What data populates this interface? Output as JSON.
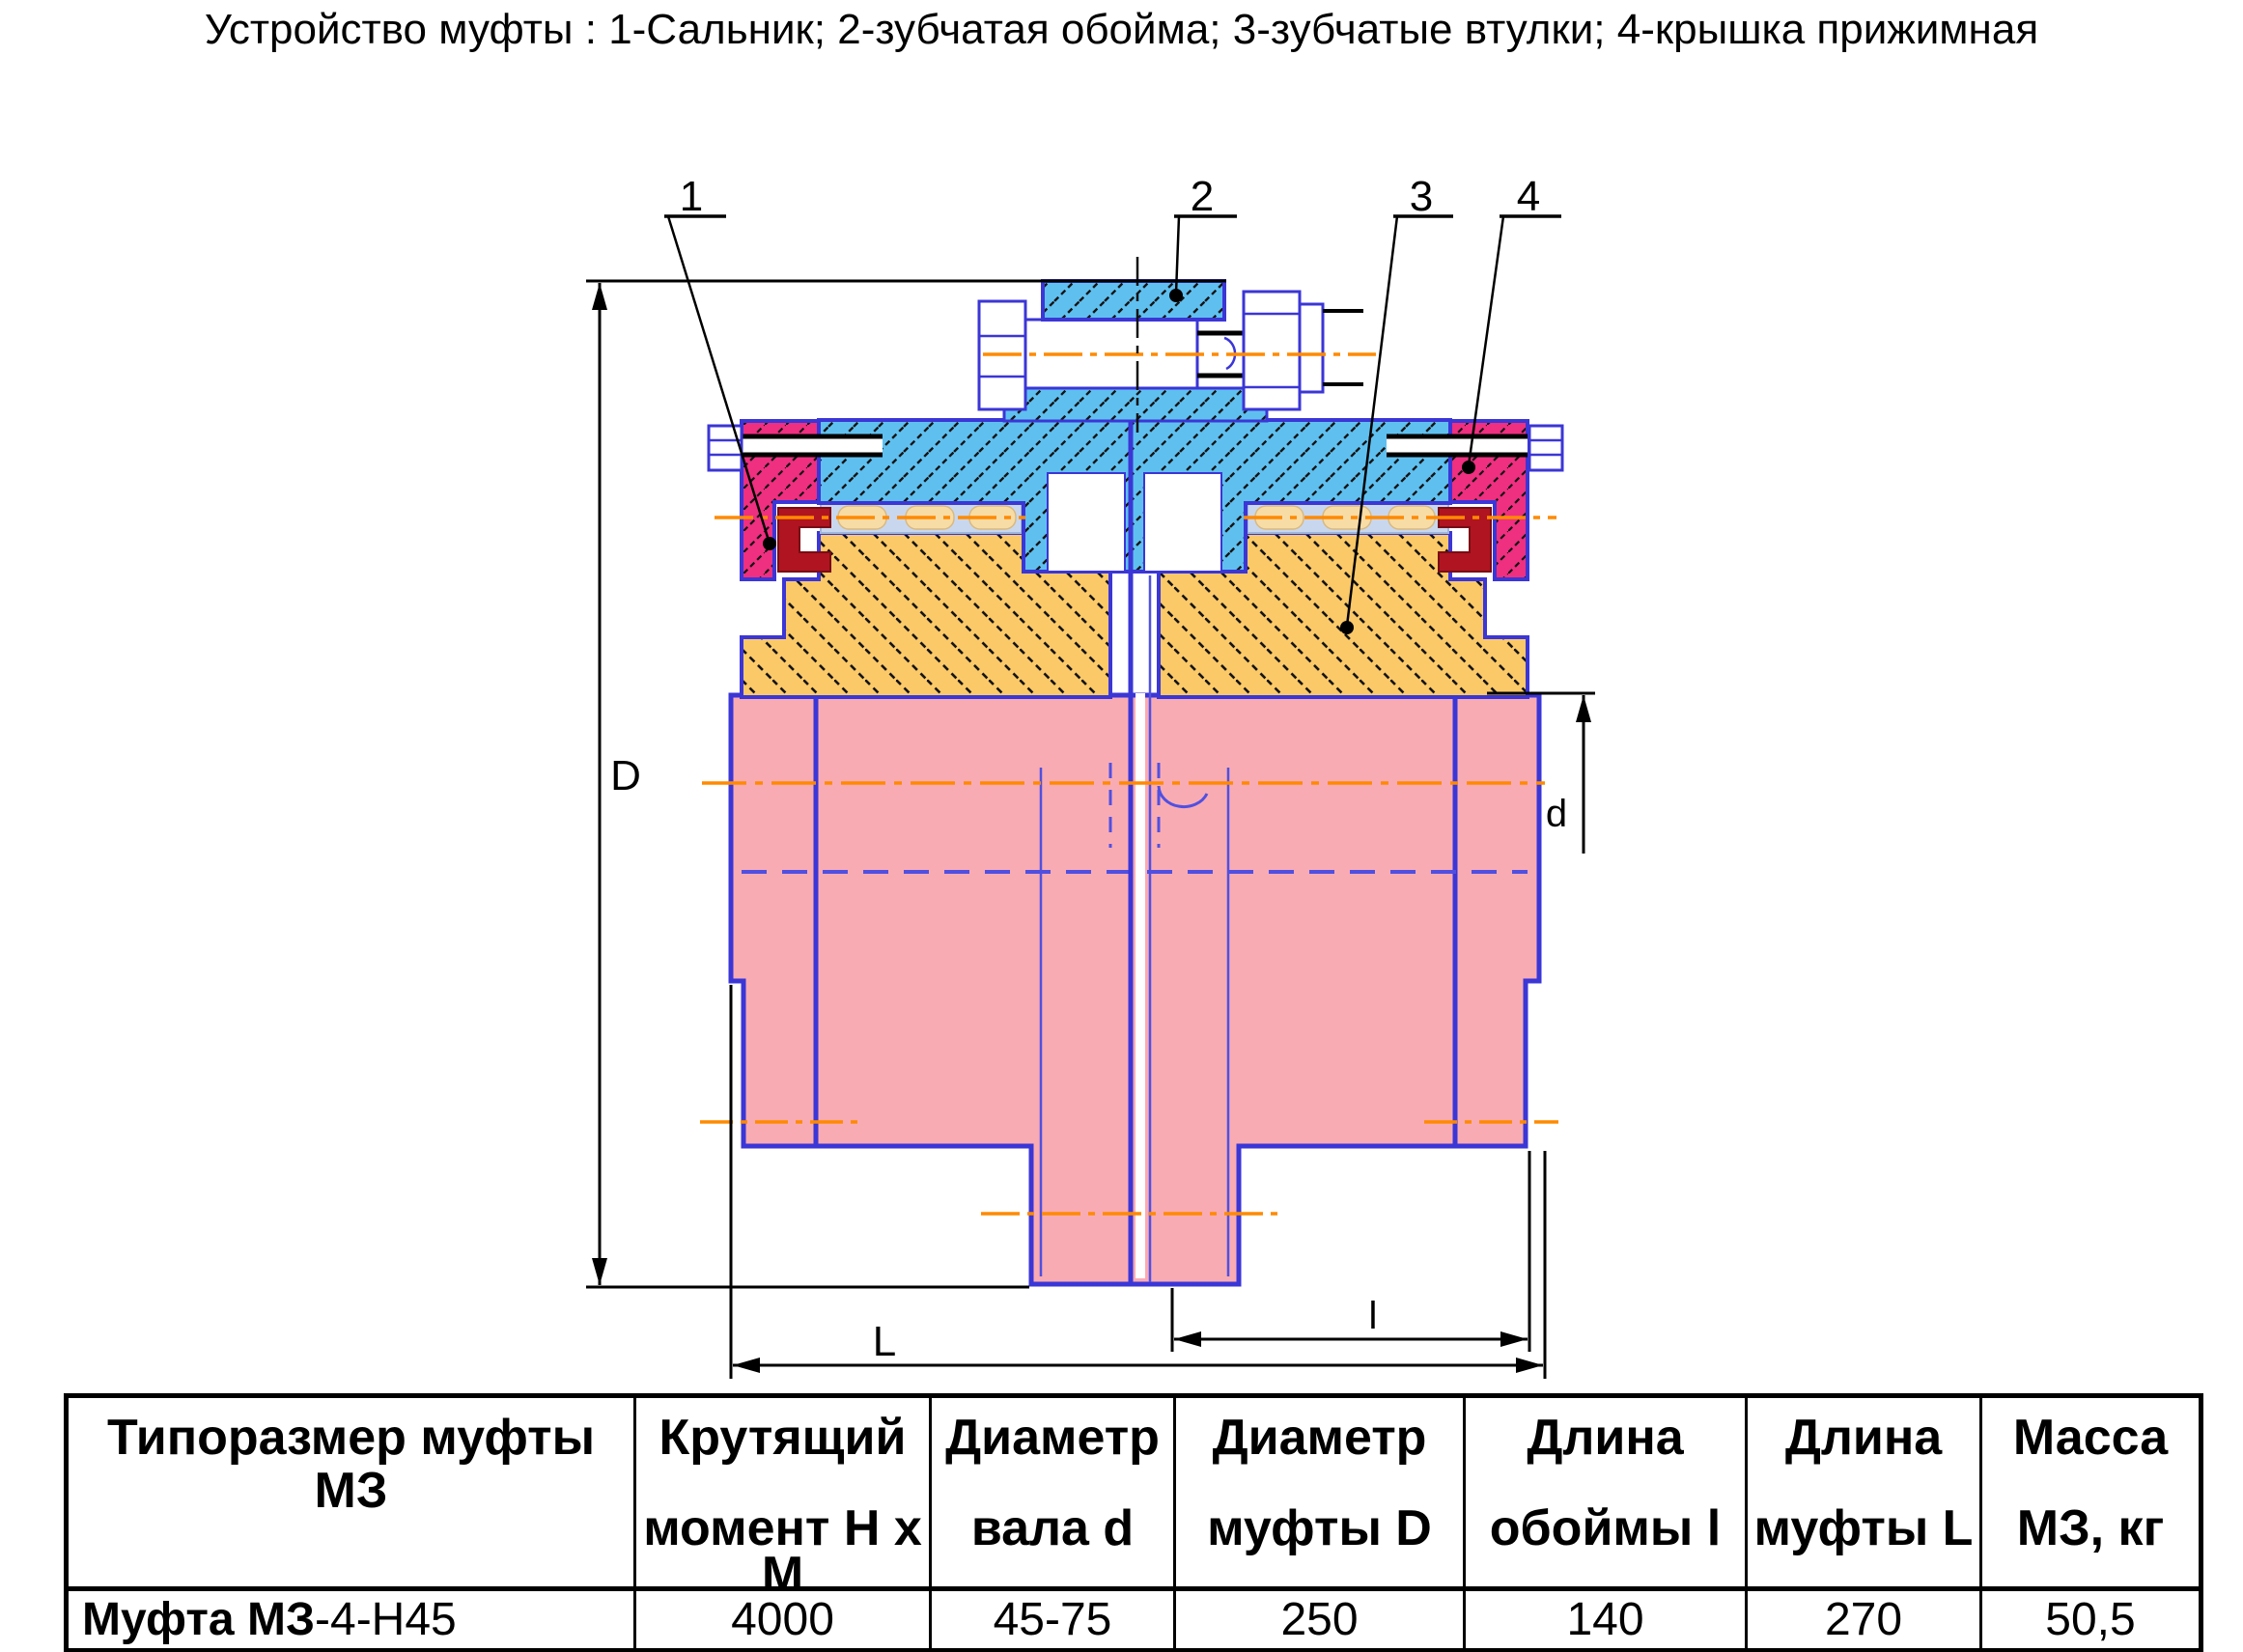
{
  "page": {
    "title": "Устройство муфты : 1-Сальник; 2-зубчатая обойма; 3-зубчатые втулки; 4-крышка прижимная"
  },
  "drawing": {
    "part_labels": {
      "p1": "1",
      "p2": "2",
      "p3": "3",
      "p4": "4"
    },
    "dim_labels": {
      "outer_diameter": "D",
      "shaft_diameter": "d",
      "coupling_length": "L",
      "sleeve_length": "l"
    },
    "colors": {
      "sleeve_blue": "#5fc0f0",
      "cap_crimson": "#ef2f80",
      "hub_orange": "#fbc968",
      "shaft_pink": "#f9abb4",
      "seal_dark_red": "#b01420",
      "outline_blue": "#3b36d6",
      "centerline_orange": "#ff8a00",
      "hidden_line_blue": "#5050e0"
    }
  },
  "table": {
    "headers": [
      {
        "line1": "Типоразмер муфты МЗ",
        "line2": ""
      },
      {
        "line1": "Крутящий",
        "line2": "момент Н х М"
      },
      {
        "line1": "Диаметр",
        "line2": "вала d"
      },
      {
        "line1": "Диаметр",
        "line2": "муфты D"
      },
      {
        "line1": "Длина",
        "line2": "обоймы l"
      },
      {
        "line1": "Длина",
        "line2": "муфты L"
      },
      {
        "line1": "Масса",
        "line2": "МЗ, кг"
      }
    ],
    "row": {
      "name_bold": "Муфта МЗ",
      "name_rest": "-4-Н45",
      "torque": "4000",
      "shaft_d": "45-75",
      "coupling_D": "250",
      "sleeve_l": "140",
      "coupling_L": "270",
      "mass": "50,5"
    }
  }
}
